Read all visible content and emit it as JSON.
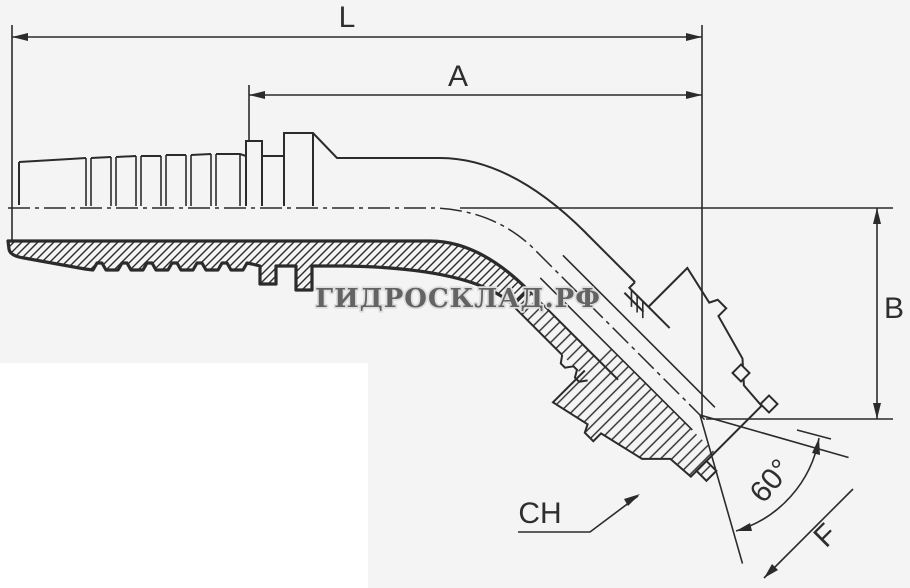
{
  "canvas": {
    "width": 910,
    "height": 588,
    "background_color": "#f4f4f4",
    "panel_color": "#ffffff",
    "line_color": "#2b2b2b"
  },
  "drawing": {
    "subject": "45-degree elbow hydraulic hose fitting with barbed hose tail, hex nut and 60-degree cone seat",
    "view": "half-section technical drawing"
  },
  "labels": {
    "overall_length": "L",
    "insert_length": "A",
    "drop_height": "B",
    "wrench_size": "CH",
    "cone_angle": "60°",
    "thread_size": "F"
  },
  "watermark": {
    "text": "ГИДРОСКЛАД.РФ",
    "fill_color": "#636363",
    "outline_color": "#dedede"
  }
}
